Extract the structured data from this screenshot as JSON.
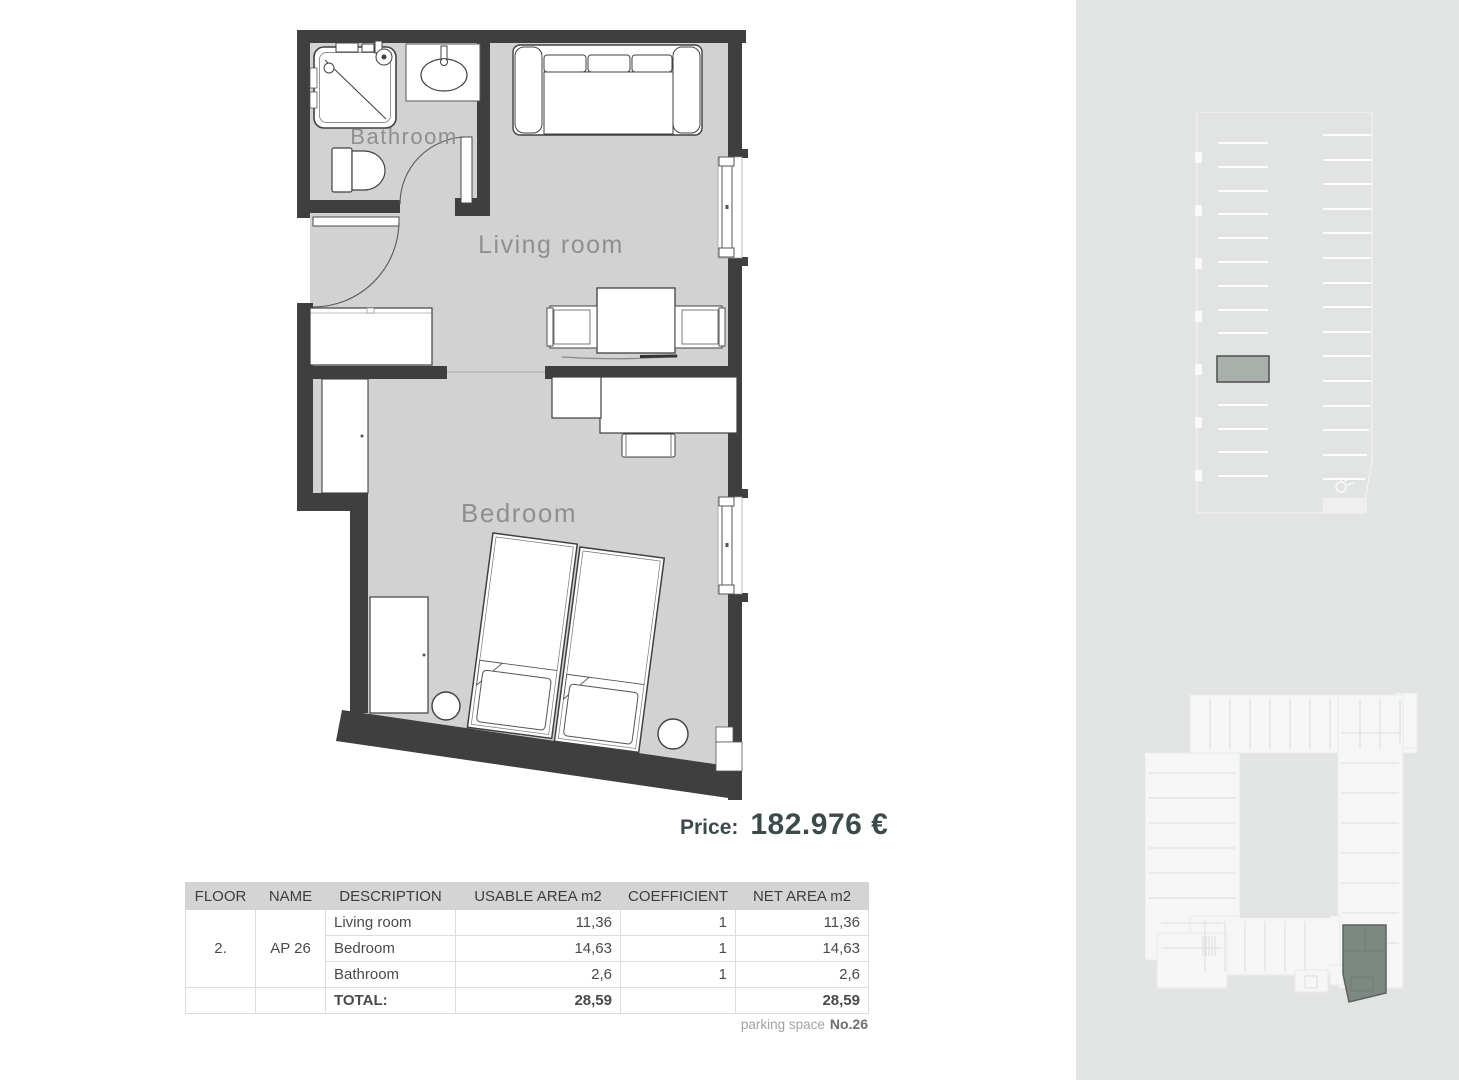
{
  "floor_plan": {
    "rooms": [
      {
        "name": "Bathroom"
      },
      {
        "name": "Living room"
      },
      {
        "name": "Bedroom"
      }
    ]
  },
  "price": {
    "label": "Price:",
    "value": "182.976 €"
  },
  "table": {
    "headers": [
      "FLOOR",
      "NAME",
      "DESCRIPTION",
      "USABLE AREA m2",
      "COEFFICIENT",
      "NET AREA m2"
    ],
    "floor": "2.",
    "name": "AP 26",
    "rows": [
      {
        "description": "Living room",
        "usable": "11,36",
        "coefficient": "1",
        "net": "11,36"
      },
      {
        "description": "Bedroom",
        "usable": "14,63",
        "coefficient": "1",
        "net": "14,63"
      },
      {
        "description": "Bathroom",
        "usable": "2,6",
        "coefficient": "1",
        "net": "2,6"
      }
    ],
    "total": {
      "label": "TOTAL:",
      "usable": "28,59",
      "net": "28,59"
    }
  },
  "parking": {
    "label": "parking space",
    "number": "No.26"
  },
  "colors": {
    "wall": "#3f3f3f",
    "floor_fill": "#d2d2d2",
    "panel_background": "#e2e3e3",
    "price_text": "#3d4a4c",
    "highlighted_parking_stall": "#a9afab",
    "highlighted_unit": "#7d8882"
  }
}
